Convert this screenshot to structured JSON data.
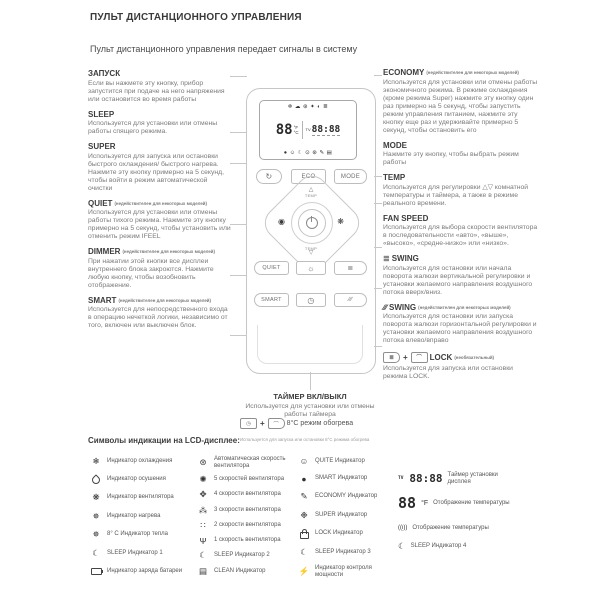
{
  "page": {
    "title": "ПУЛЬТ ДИСТАНЦИОННОГО УПРАВЛЕНИЯ",
    "subtitle": "Пульт дистанционного управления передает сигналы в систему"
  },
  "left_sections": [
    {
      "heading": "ЗАПУСК",
      "note": "",
      "body": "Если вы нажмете эту кнопку, прибор запустится при подаче на него напряжения или остановится во время работы"
    },
    {
      "heading": "SLEEP",
      "note": "",
      "body": "Используется для установки или отмены работы спящего режима."
    },
    {
      "heading": "SUPER",
      "note": "",
      "body": "Используется для запуска или остановки быстрого охлаждения/ быстрого нагрева. Нажмите эту кнопку примерно на 5 секунд, чтобы войти в режим автоматической очистки"
    },
    {
      "heading": "QUIET",
      "note": "(недействителен для некоторых моделей)",
      "body": "Используется для установки или отмены работы тихого режима. Нажмите эту кнопку примерно на 5 секунд, чтобы установить или отменить режим IFEEL"
    },
    {
      "heading": "DIMMER",
      "note": "(недействителен для некоторых моделей)",
      "body": "При нажатии этой кнопки все дисплеи внутреннего блока закроются. Нажмите любую кнопку, чтобы возобновить отображение."
    },
    {
      "heading": "SMART",
      "note": "(недействителен для некоторых моделей)",
      "body": "Используется для непосредственного входа в операцию нечеткой логики, независимо от того, включен или выключен блок."
    }
  ],
  "right_sections": [
    {
      "heading": "ECONOMY",
      "note": "(недействителен для некоторых моделей)",
      "body": "Используется для установки или отмены работы экономичного режима. В режиме охлаждения (кроме режима Super) нажмите эту кнопку один раз примерно на 5 секунд, чтобы запустить режим управления питанием, нажмите эту кнопку еще раз и удерживайте примерно 5 секунд, чтобы остановить его"
    },
    {
      "heading": "MODE",
      "note": "",
      "body": "Нажмите эту кнопку, чтобы выбрать режим работы"
    },
    {
      "heading": "TEMP",
      "note": "",
      "body": "Используется для регулировки △▽ комнатной температуры и таймера, а также в режиме реального времени."
    },
    {
      "heading": "FAN SPEED",
      "note": "",
      "body": "Используется для выбора скорости вентилятора в последовательности «авто», «выше», «высоко», «средне-низко» или «низко»."
    },
    {
      "heading": "SWING",
      "icon_glyph": "≣",
      "note": "",
      "body": "Используется для остановки или начала поворота жалюзи вертикальной регулировки и установки желаемого направления воздушного потока вверх/вниз."
    },
    {
      "heading": "SWING",
      "icon_glyph": "∕∕∕",
      "note": "(недействителен для некоторых моделей)",
      "body": "Используется для остановки или запуска поворота жалюзи горизонтальной регулировки и установки желаемого направления воздушного потока влево/вправо"
    },
    {
      "heading": "LOCK",
      "note": "(необязательный)",
      "combo_btn1": "≣",
      "combo_btn2": "⌒",
      "plus": "+",
      "body": "Используется для запуска или остановки режима LOCK."
    }
  ],
  "timer_section": {
    "heading": "ТАЙМЕР ВКЛ/ВЫКЛ",
    "body": "Используется для установки или отмены работы таймера",
    "combo_btn1": "◷",
    "combo_plus": "+",
    "combo_btn2": "⌒",
    "combo_label": "8°C режим обогрева",
    "footnote": "Используется для запуска или остановки 8°C режима обогрева"
  },
  "remote": {
    "lcd_icons_top": "❄ ☁ ⊛ ✦ ◐ ≣",
    "lcd_temp": "88",
    "lcd_deg_f": "°F",
    "lcd_deg_c": "°C",
    "lcd_tv": "TV",
    "lcd_time": "88:88",
    "lcd_icons_bottom": "● ☺ ☾ ⊙ ⊛ ✎ ▤",
    "sleep_btn_glyph": "↻",
    "eco_label": "ECO",
    "mode_label": "MODE",
    "temp_up": "△",
    "temp_down": "▽",
    "temp_label": "TEMP",
    "super_glyph": "◉",
    "fan_glyph": "❋",
    "quiet_label": "QUIET",
    "dimmer_glyph": "☼",
    "swing_v_glyph": "≣",
    "smart_label": "SMART",
    "timer_glyph": "◷",
    "swing_h_glyph": "∕∕∕"
  },
  "legend": {
    "heading": "Символы индикации на LCD-дисплее:",
    "col1": [
      {
        "icon": "snowflake",
        "glyph": "❄",
        "label": "Индикатор охлаждения"
      },
      {
        "icon": "water-drop",
        "shape": "drop",
        "label": "Индикатор осушения"
      },
      {
        "icon": "fan",
        "glyph": "❋",
        "label": "Индикатор вентилятора"
      },
      {
        "icon": "heat",
        "glyph": "✵",
        "label": "Индикатор нагрева"
      },
      {
        "icon": "heat-8c",
        "glyph": "✵",
        "label": "8° C Индикатор тепла"
      },
      {
        "icon": "moon",
        "glyph": "☾",
        "label": "SLEEP Индикатор 1"
      },
      {
        "icon": "battery",
        "shape": "battery",
        "label": "Индикатор заряда батареи"
      }
    ],
    "col2": [
      {
        "icon": "auto-fan",
        "glyph": "⊛",
        "label": "Автоматическая скорость вентилятора"
      },
      {
        "icon": "fan-speed-5",
        "glyph": "✺",
        "label": "5 скоростей вентилятора"
      },
      {
        "icon": "fan-speed-4",
        "glyph": "✥",
        "label": "4 скорости вентилятора"
      },
      {
        "icon": "fan-speed-3",
        "glyph": "⁂",
        "label": "3 скорости вентилятора"
      },
      {
        "icon": "fan-speed-2",
        "glyph": "∷",
        "label": "2 скорости вентилятора"
      },
      {
        "icon": "fan-speed-1",
        "glyph": "Ψ",
        "label": "1 скорость вентилятора"
      },
      {
        "icon": "moon",
        "glyph": "☾",
        "label": "SLEEP Индикатор 2"
      },
      {
        "icon": "clean",
        "glyph": "▤",
        "label": "CLEAN Индикатор"
      }
    ],
    "col3": [
      {
        "icon": "smiley",
        "glyph": "☺",
        "label": "QUITE Индикатор"
      },
      {
        "icon": "dot",
        "glyph": "●",
        "label": "SMART Индикатор"
      },
      {
        "icon": "pencil",
        "glyph": "✎",
        "label": "ECONOMY Индикатор"
      },
      {
        "icon": "sparkle",
        "glyph": "❉",
        "label": "SUPER Индикатор"
      },
      {
        "icon": "lock",
        "shape": "lock",
        "label": "LOCK Индикатор"
      },
      {
        "icon": "moon",
        "glyph": "☾",
        "label": "SLEEP Индикатор 3"
      },
      {
        "icon": "bolt",
        "glyph": "⚡",
        "label": "Индикатор контроля мощности"
      }
    ],
    "col4": {
      "timer": {
        "tv": "TV",
        "digits": "88:88",
        "label": "Таймер установки дисплея"
      },
      "temp": {
        "digits": "88",
        "unit": "°F",
        "label": "Отображение температуры"
      },
      "signal": {
        "glyph": "((ᴉ))",
        "label": "Отображение температуры"
      },
      "sleep4": {
        "glyph": "☾",
        "label": "SLEEP Индикатор 4"
      }
    }
  }
}
